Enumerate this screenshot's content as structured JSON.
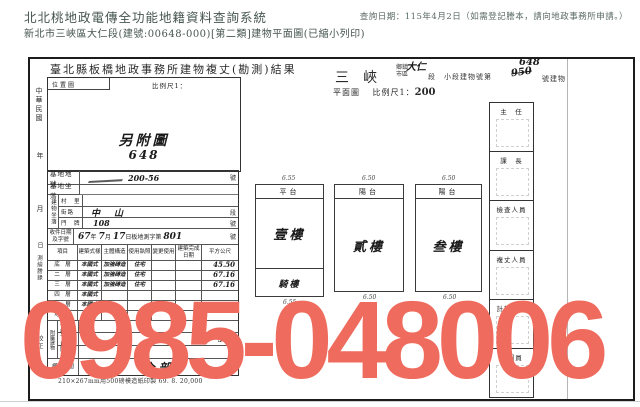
{
  "header": {
    "system_title": "北北桃地政電傳全功能地籍資料查詢系統",
    "query_date": "查詢日期：115年4月2日（如需登記謄本，請向地政事務所申請。）",
    "doc_line": "新北市三峽區大仁段(建號:00648-000)[第二類]建物平面圖(已縮小列印)"
  },
  "document": {
    "title": "臺北縣板橋地政事務所建物複丈(勘測)結果",
    "township": "三峽",
    "township_label": "鄉鎮市區",
    "section_hand": "大仁",
    "number_line_prefix": "段　小段建物號第",
    "number_struck": "950",
    "number_hand": "648",
    "number_line_suffix": "號建物",
    "plan_label": "平面圖",
    "scale_label": "比例尺1：",
    "scale_value": "200",
    "location_box": {
      "title": "位置圖",
      "scale_label": "比例尺1：",
      "hand_line1": "另附圖",
      "hand_line2": "648"
    },
    "margin_left": {
      "era": "中華民國",
      "year": "年",
      "month": "月",
      "day": "日",
      "note1": "測繪謄錄",
      "note2": "校正"
    },
    "form": {
      "lot_label": "基地地號",
      "lot_hand": "200-56",
      "lot_suffix": "號",
      "site_label": "基地坐落",
      "bld_label": "建物坐落",
      "village_label": "村　里",
      "street_hand": "中山",
      "street_label": "街路",
      "street_suffix": "段",
      "door_label": "門　牌",
      "door_hand": "108",
      "door_suffix": "號",
      "receipt_label": "收件日期及字號",
      "receipt_hand_year": "67",
      "receipt_y": "年",
      "receipt_hand_month": "7",
      "receipt_m": "月",
      "receipt_hand_day": "17",
      "receipt_d": "日板地測字第",
      "receipt_hand_no": "801",
      "receipt_suffix": "號"
    },
    "table": {
      "headers": [
        "項目",
        "建築式樣",
        "主體構造",
        "使用執照",
        "變更使用",
        "建築完成日期",
        "平方公尺"
      ],
      "rows": [
        {
          "floor": "底　層",
          "style": "本國式",
          "structure": "加強磚造",
          "use": "住宅",
          "area": "45.50"
        },
        {
          "floor": "二　層",
          "style": "本國式",
          "structure": "加強磚造",
          "use": "住宅",
          "area": "67.16"
        },
        {
          "floor": "三　層",
          "style": "本國式",
          "structure": "加強磚造",
          "use": "住宅",
          "area": "67.16"
        },
        {
          "floor": "四　層",
          "style": "本國式",
          "structure": "",
          "use": "",
          "area": ""
        },
        {
          "floor": "五　層",
          "style": "本國式",
          "structure": "",
          "use": "",
          "area": ""
        },
        {
          "floor": "地下室",
          "style": "",
          "structure": "",
          "use": "",
          "area": ""
        }
      ],
      "annex_label": "附屬建物",
      "annex_rows": [
        {
          "name": "騎　樓",
          "area": ""
        },
        {
          "name": "平　台",
          "area": "5.66"
        },
        {
          "name": "陽　台",
          "area": ""
        }
      ],
      "rights_label": "權利範圍",
      "rights_hand": "全部"
    },
    "footnote": "210×267mm用500磅模造紙印製 69. 8. 20,000",
    "plan_units": [
      {
        "top": "平台",
        "main": "壹樓",
        "bottom": "騎樓",
        "dim_top": "6.55",
        "dim_bottom": "6.55"
      },
      {
        "top": "陽台",
        "main": "貳樓",
        "bottom": "",
        "dim_top": "6.50",
        "dim_bottom": "6.50"
      },
      {
        "top": "陽台",
        "main": "叁樓",
        "bottom": "",
        "dim_top": "6.50",
        "dim_bottom": "6.50"
      }
    ],
    "officials": [
      "主　任",
      "課　長",
      "檢查人員",
      "複丈人員",
      "計算人員",
      "繪圖員"
    ]
  },
  "watermark": {
    "text": "0985-048006",
    "color": "#ef6b5d"
  }
}
